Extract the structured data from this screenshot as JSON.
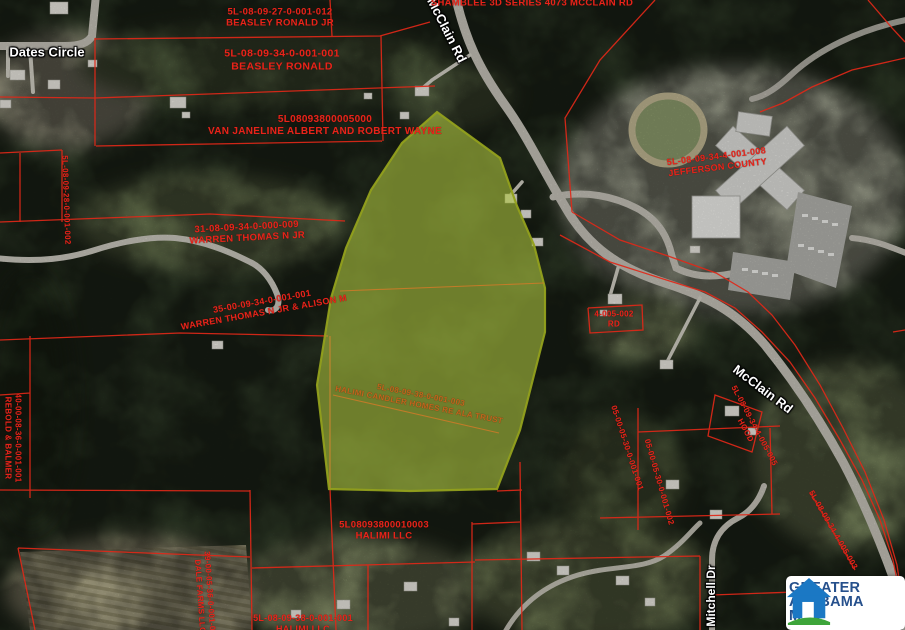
{
  "map": {
    "road_labels": [
      {
        "text": "Dates Circle",
        "x": 47,
        "y": 52,
        "rot": 0,
        "size": 13
      },
      {
        "text": "McClain Rd",
        "x": 447,
        "y": 30,
        "rot": 63,
        "size": 13
      },
      {
        "text": "McClain Rd",
        "x": 763,
        "y": 389,
        "rot": 37,
        "size": 13
      },
      {
        "text": "Mitchell Dr",
        "x": 711,
        "y": 596,
        "rot": -90,
        "size": 12
      }
    ],
    "parcel_labels": [
      {
        "lines": [
          "5L-08-09-27-0-001-012",
          "BEASLEY RONALD JR"
        ],
        "x": 280,
        "y": 18,
        "rot": 0,
        "size": 9.5
      },
      {
        "lines": [
          "5L-08-09-34-0-001-001",
          "BEASLEY RONALD"
        ],
        "x": 282,
        "y": 60,
        "rot": 0,
        "size": 10.5
      },
      {
        "lines": [
          "5L08093800005000",
          "VAN JANELINE ALBERT AND ROBERT WAYNE"
        ],
        "x": 325,
        "y": 126,
        "rot": 0,
        "size": 10
      },
      {
        "lines": [
          "31-08-09-34-0-000-009",
          "WARREN THOMAS N JR"
        ],
        "x": 247,
        "y": 233,
        "rot": -3,
        "size": 9.5
      },
      {
        "lines": [
          "35-00-09-34-0-001-001",
          "WARREN THOMAS N JR & ALISON M"
        ],
        "x": 263,
        "y": 307,
        "rot": -10,
        "size": 9
      },
      {
        "lines": [
          "5L-08-09-38-0-001-003",
          "HALIMI CANDLER HOMES RE ALA TRUST"
        ],
        "x": 420,
        "y": 400,
        "rot": 11,
        "size": 8,
        "color": "#c2661c"
      },
      {
        "lines": [
          "5L08093800010003",
          "HALIMI LLC"
        ],
        "x": 384,
        "y": 531,
        "rot": 0,
        "size": 9.5
      },
      {
        "lines": [
          "5L-08-09-34-4-001-008",
          "JEFFERSON COUNTY"
        ],
        "x": 717,
        "y": 162,
        "rot": -7,
        "size": 9
      },
      {
        "lines": [
          "4-005-002",
          "RD"
        ],
        "x": 614,
        "y": 319,
        "rot": 0,
        "size": 8
      },
      {
        "lines": [
          "5L-08-09-34-4-005-005",
          "HOOD"
        ],
        "x": 750,
        "y": 428,
        "rot": 62,
        "size": 8
      },
      {
        "lines": [
          "05-00-05-30-0-001-001"
        ],
        "x": 627,
        "y": 448,
        "rot": 72,
        "size": 8
      },
      {
        "lines": [
          "05-00-05-30-0-001-002"
        ],
        "x": 659,
        "y": 482,
        "rot": 74,
        "size": 8
      },
      {
        "lines": [
          "40-00-08-36-0-001-001",
          "REBOLD & BALMER"
        ],
        "x": 13,
        "y": 438,
        "rot": 90,
        "size": 8
      },
      {
        "lines": [
          "5L-08-09-28-0-001-002"
        ],
        "x": 66,
        "y": 200,
        "rot": 88,
        "size": 8
      },
      {
        "lines": [
          "39-00-05-36-0-001-001",
          "DALE FARMS LLC"
        ],
        "x": 205,
        "y": 596,
        "rot": 86,
        "size": 8
      },
      {
        "lines": [
          "5L-08-09-38-0-001-001",
          "HALIMI LLC"
        ],
        "x": 303,
        "y": 624,
        "rot": 0,
        "size": 9
      },
      {
        "lines": [
          "5L-08-09-34-4-005-003"
        ],
        "x": 833,
        "y": 530,
        "rot": 60,
        "size": 8
      },
      {
        "lines": [
          "SHAMBLEE 3D SERIES 4073 MCCLAIN RD"
        ],
        "x": 532,
        "y": 3,
        "rot": 0,
        "size": 9.5
      }
    ]
  },
  "highlight": {
    "fill": "rgba(173,197,64,0.60)",
    "stroke": "rgba(146,160,28,0.95)"
  },
  "colors": {
    "parcel_line": "#e02818",
    "parcel_text": "#e8241a",
    "road_label": "#ffffff",
    "interior_line": "#d07a28"
  },
  "logo": {
    "line1": "GREATER",
    "line2": "ALABAMA",
    "line3": "MLS",
    "house_color": "#1b78c4",
    "ground_color": "#3da53a",
    "text_color": "#26508c",
    "bg": "#ffffff"
  }
}
